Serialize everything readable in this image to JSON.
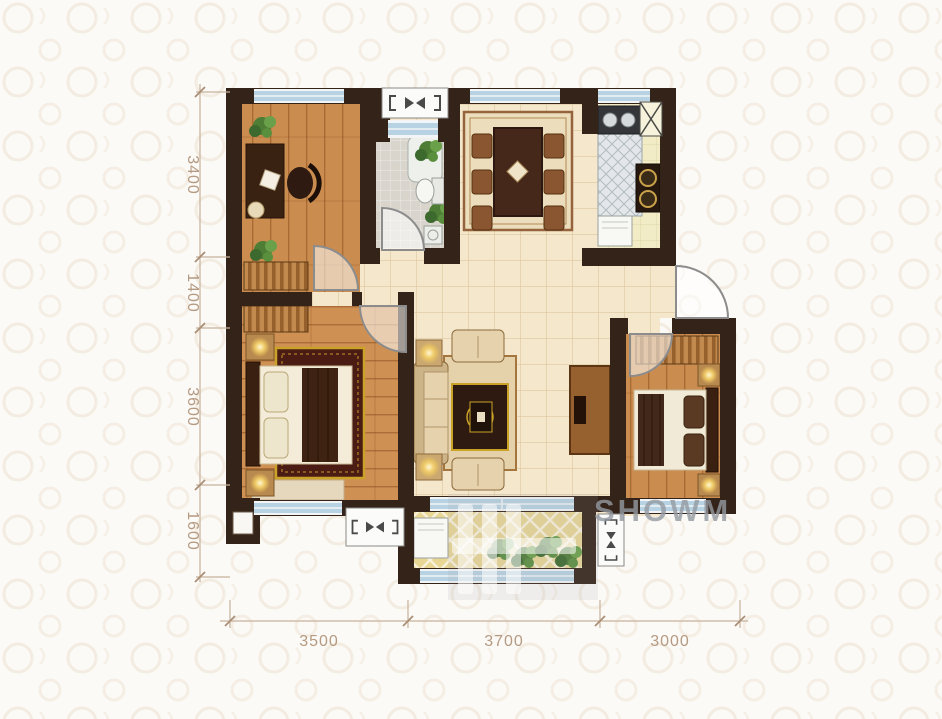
{
  "title": "apartment-floor-plan",
  "watermark": {
    "text": "SHOWM"
  },
  "dimensions": {
    "left": [
      {
        "label": "3400"
      },
      {
        "label": "1400"
      },
      {
        "label": "3600"
      },
      {
        "label": "1600"
      }
    ],
    "bottom": [
      {
        "label": "3500"
      },
      {
        "label": "3700"
      },
      {
        "label": "3000"
      }
    ]
  },
  "colors": {
    "wall": "#342318",
    "wood_floor": "#ca8a4e",
    "hall_tile": "#f4e7cb",
    "bath_tile": "#d9d5cd",
    "kitchen_floor": "#f2ecc6",
    "balcony_floor": "#e8d694",
    "window_glass": "#b7d2e2",
    "rug_red": "#4a1c14",
    "rug_gold": "#c9a227",
    "plant_green": "#5a8f3e",
    "dimension_text": "#b49a82",
    "watermark_gray": "#949aa2",
    "background": "#fcfaf7"
  },
  "icons": {
    "ac_unit_symbol": "bracket-bowtie",
    "flue_symbol": "x-box",
    "door_swing": "quarter-arc",
    "window": "blue-strip"
  }
}
